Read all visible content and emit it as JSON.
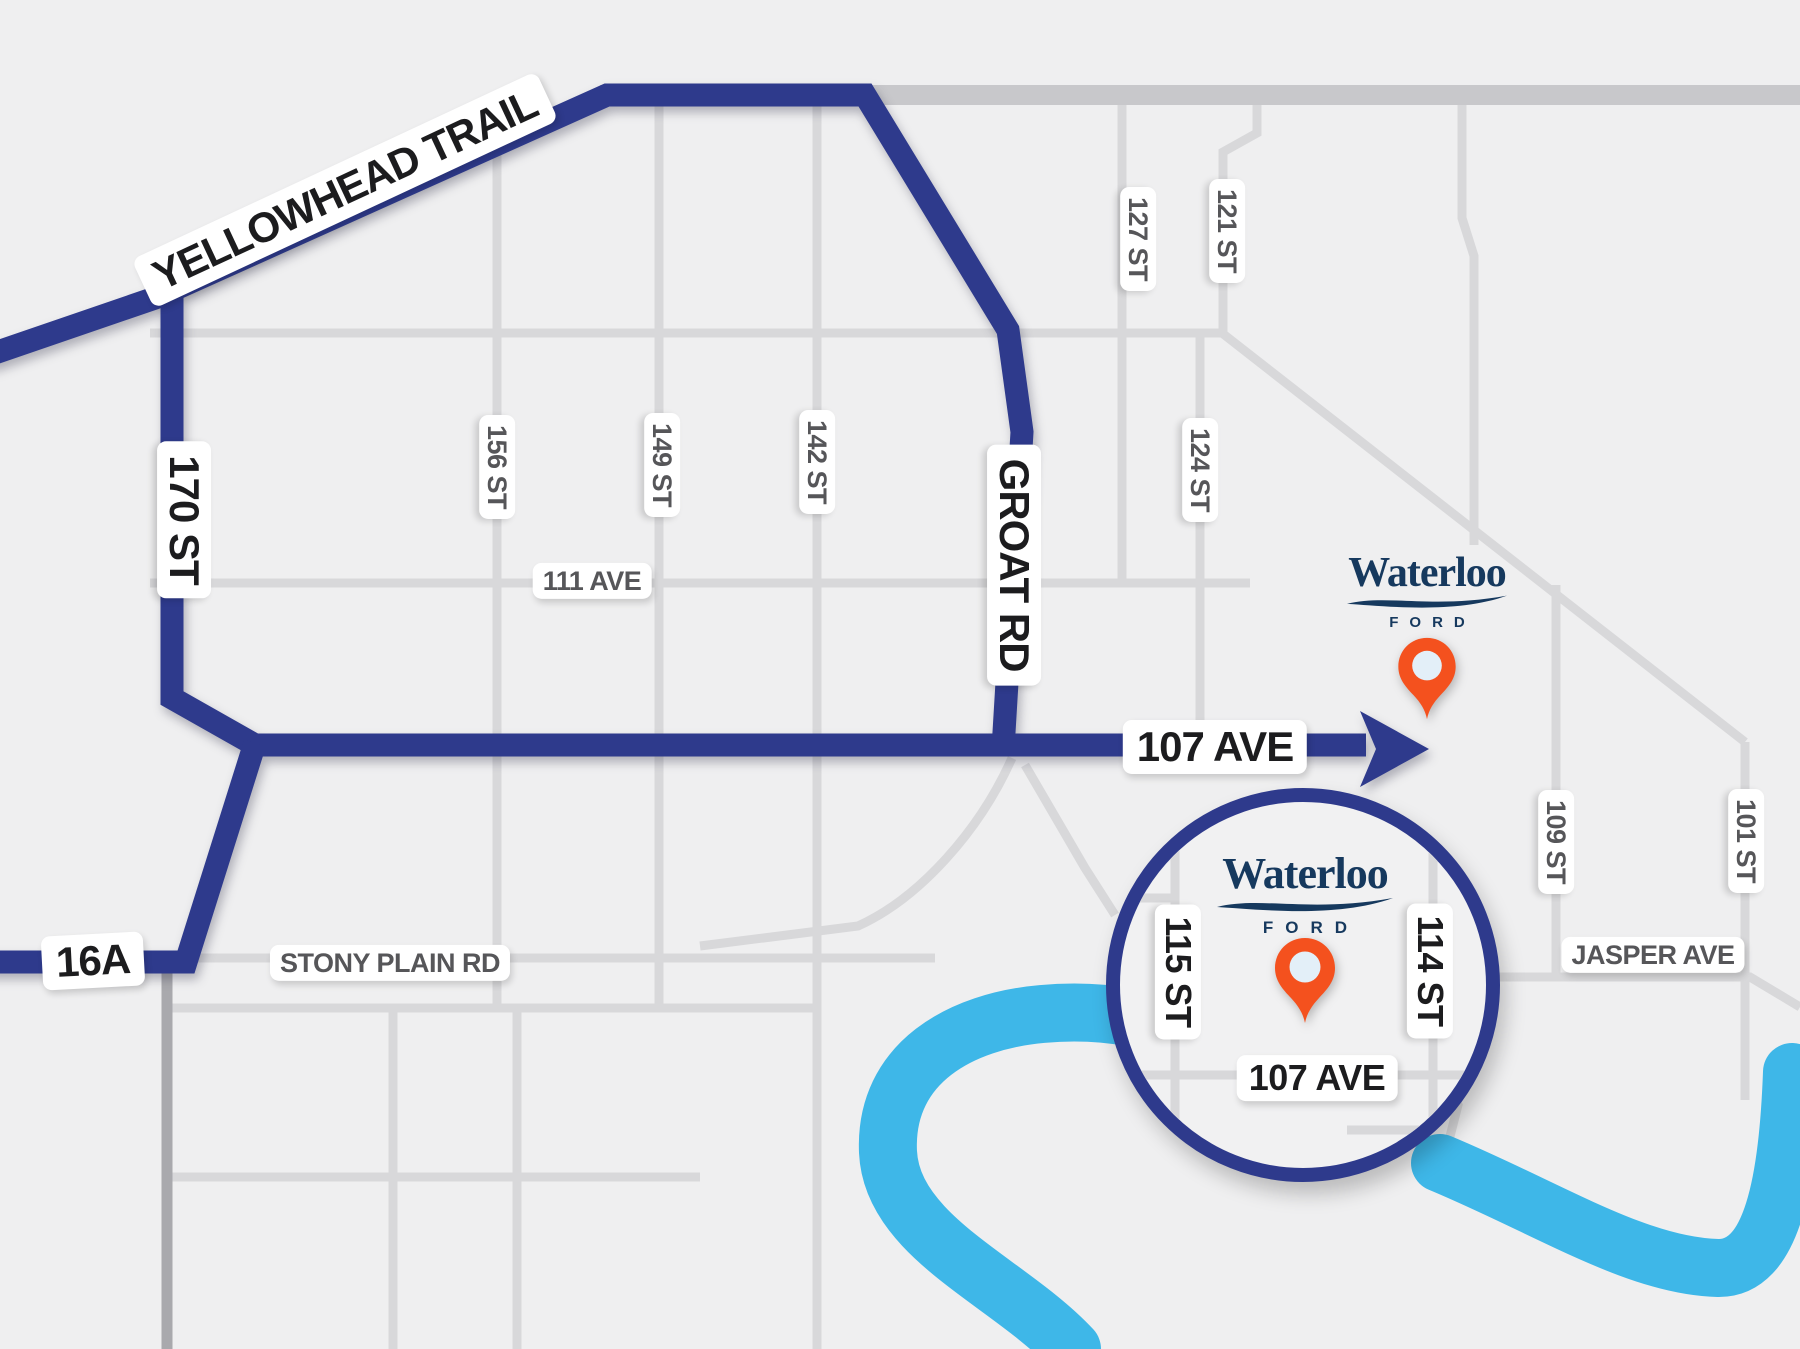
{
  "map_labels": {
    "yellowhead_trail": "YELLOWHEAD TRAIL",
    "st_170": "170 ST",
    "groat_rd": "GROAT RD",
    "ave_107": "107 AVE",
    "hwy_16a": "16A",
    "st_156": "156 ST",
    "st_149": "149 ST",
    "st_142": "142 ST",
    "ave_111": "111 AVE",
    "st_127": "127 ST",
    "st_121": "121 ST",
    "st_124": "124 ST",
    "stony_plain_rd": "STONY PLAIN RD",
    "jasper_ave": "JASPER AVE",
    "st_109": "109 ST",
    "st_101": "101 ST"
  },
  "inset_labels": {
    "st_115": "115 ST",
    "st_114": "114 ST",
    "ave_107": "107 AVE"
  },
  "brand": {
    "wordmark": "Waterloo",
    "division": "FORD"
  },
  "colors": {
    "route": "#2e3a8c",
    "river": "#3eb7e8",
    "pin_orange": "#f4511e",
    "pin_hole": "#e3eff8",
    "brand_navy": "#16395e",
    "road_gray": "#d8d8da",
    "background": "#efeff0"
  }
}
